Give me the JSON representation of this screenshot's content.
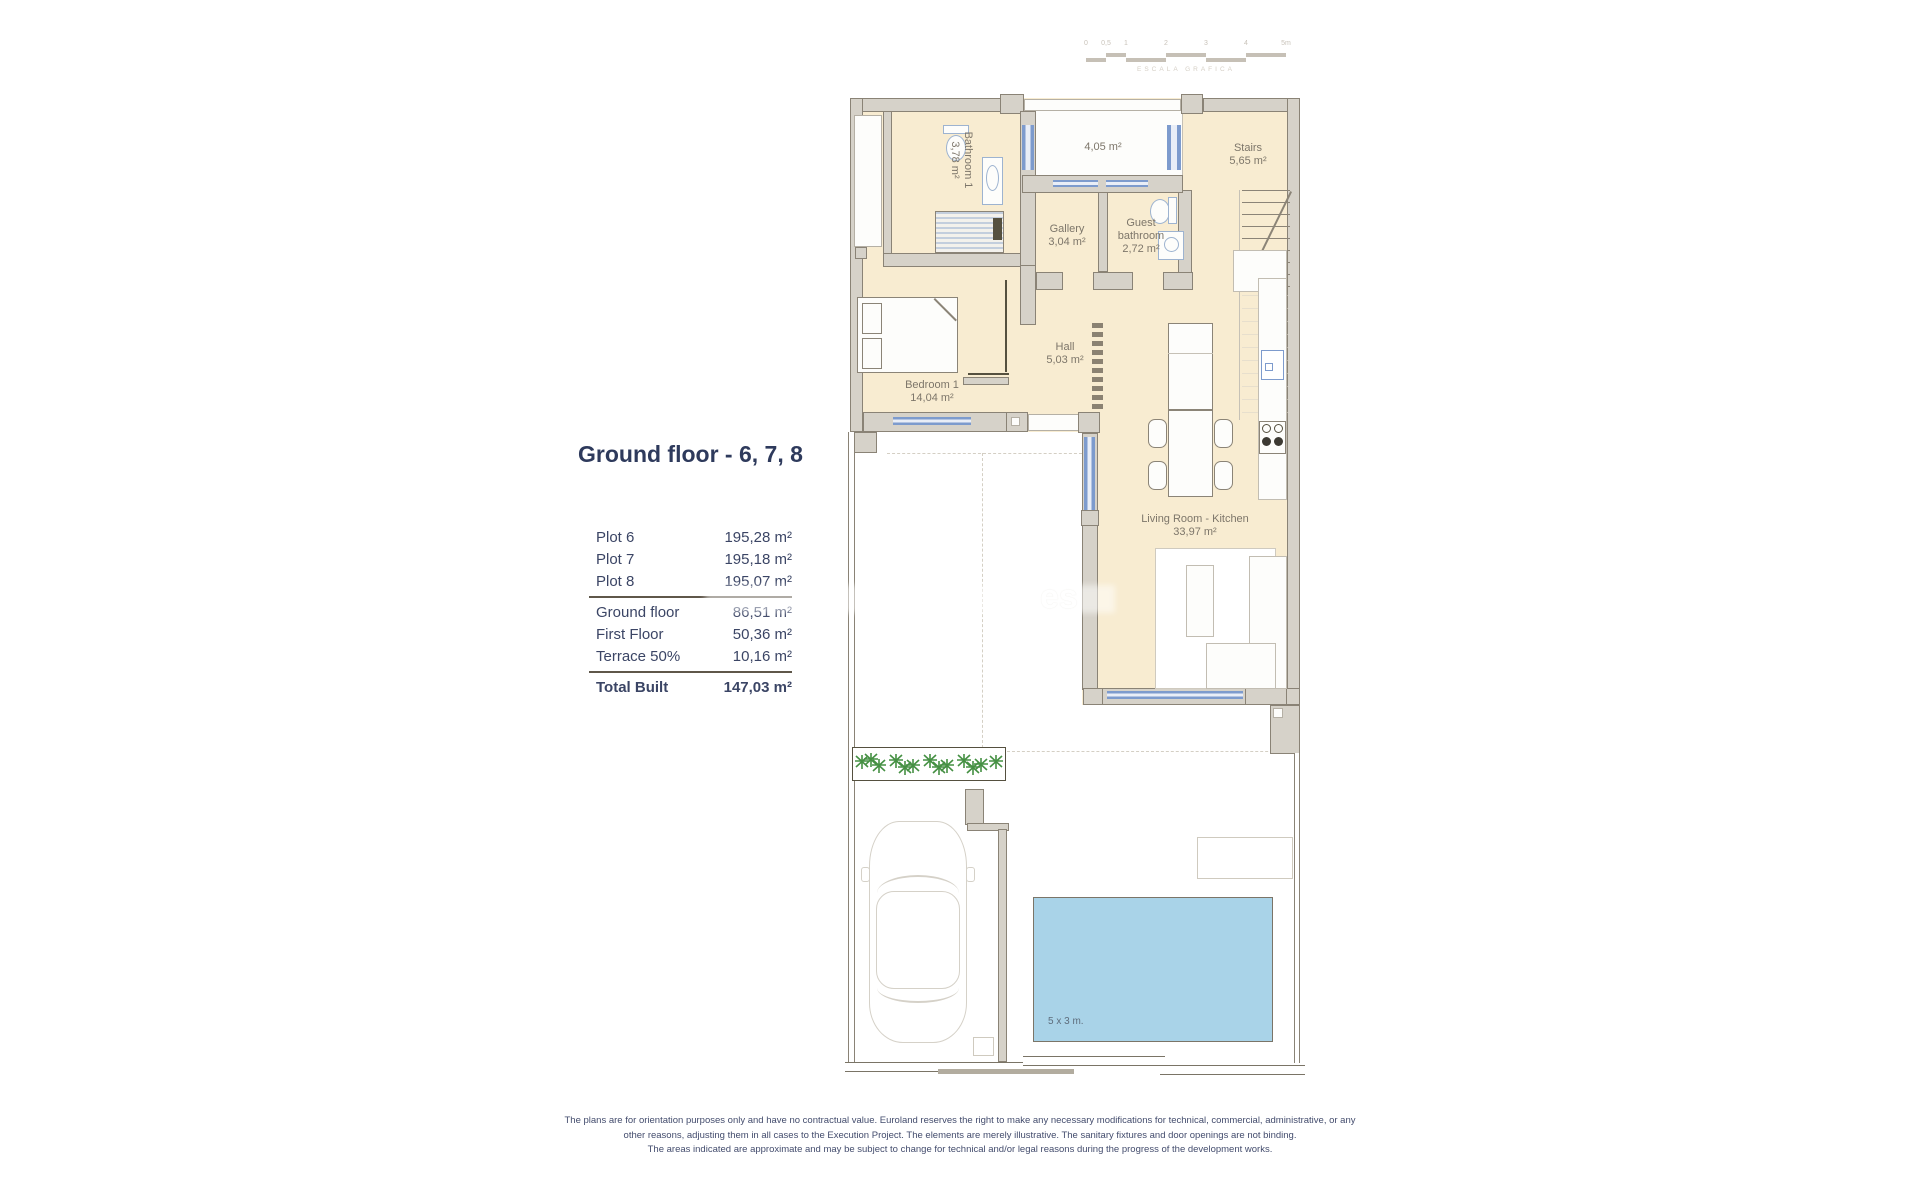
{
  "title": "Ground floor - 6, 7, 8",
  "table": {
    "plots": [
      {
        "label": "Plot 6",
        "value": "195,28 m²"
      },
      {
        "label": "Plot 7",
        "value": "195,18 m²"
      },
      {
        "label": "Plot 8",
        "value": "195,07 m²"
      }
    ],
    "floors": [
      {
        "label": "Ground floor",
        "value": "86,51 m²"
      },
      {
        "label": "First Floor",
        "value": "50,36 m²"
      },
      {
        "label": "Terrace 50%",
        "value": "10,16 m²"
      }
    ],
    "total": {
      "label": "Total Built",
      "value": "147,03 m²"
    }
  },
  "rooms": {
    "bathroom1": {
      "name": "Bathroom 1",
      "area": "3,78 m²"
    },
    "patio": {
      "area": "4,05 m²"
    },
    "stairs": {
      "name": "Stairs",
      "area": "5,65 m²"
    },
    "gallery": {
      "name": "Gallery",
      "area": "3,04 m²"
    },
    "guest_bathroom": {
      "name": "Guest bathroom",
      "area": "2,72 m²"
    },
    "hall": {
      "name": "Hall",
      "area": "5,03 m²"
    },
    "bedroom1": {
      "name": "Bedroom 1",
      "area": "14,04 m²"
    },
    "living_kitchen": {
      "name": "Living Room - Kitchen",
      "area": "33,97 m²"
    }
  },
  "pool": {
    "label": "5 x 3 m."
  },
  "scale": {
    "labels": [
      "0",
      "0,5",
      "1",
      "2",
      "3",
      "4",
      "5m"
    ],
    "caption": "ESCALA GRAFICA"
  },
  "watermark": "es",
  "disclaimer": [
    "The plans are for orientation purposes only and have no contractual value. Euroland reserves the right to make any necessary modifications for technical, commercial, administrative, or any",
    "other reasons, adjusting them in all cases to the Execution Project. The elements are merely illustrative. The sanitary fixtures and door openings are not binding.",
    "The areas indicated are approximate and may be subject to change for technical and/or legal reasons during the progress of the development works."
  ],
  "colors": {
    "floor": "#f8ecd1",
    "wall": "#d6d2c9",
    "window": "#7d9bcd",
    "pool": "#a9d3e8",
    "plants": "#459043",
    "text_navy": "#2e3a5c",
    "text_label": "#7d766a"
  }
}
